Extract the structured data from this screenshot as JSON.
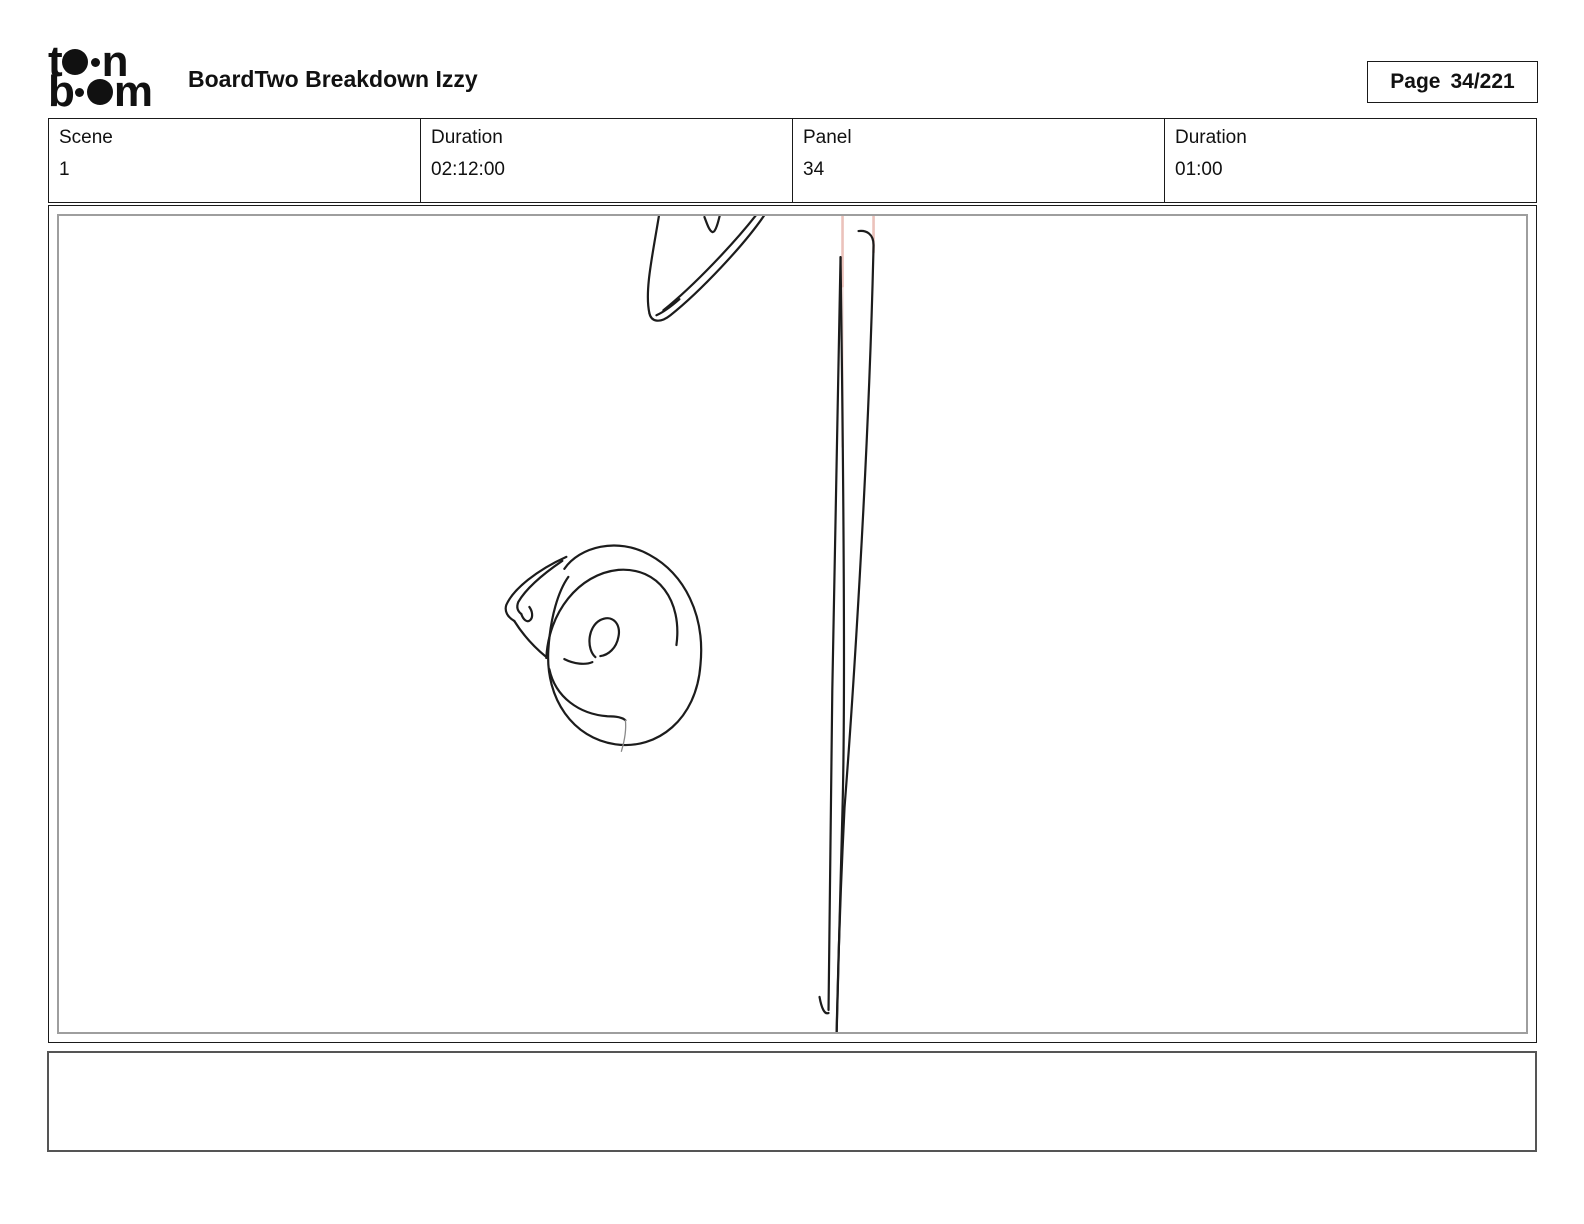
{
  "header": {
    "logo": {
      "name": "toonboom-logo",
      "row1": {
        "letter_left": "t",
        "letter_right": "n"
      },
      "row2": {
        "letter_left": "b",
        "letter_right": "m"
      }
    },
    "title": "BoardTwo Breakdown Izzy",
    "page_box": {
      "label": "Page",
      "value": "34/221"
    }
  },
  "info_table": {
    "cells": [
      {
        "label": "Scene",
        "value": "1"
      },
      {
        "label": "Duration",
        "value": "02:12:00"
      },
      {
        "label": "Panel",
        "value": "34"
      },
      {
        "label": "Duration",
        "value": "01:00"
      }
    ]
  },
  "panel": {
    "caption": "",
    "sketch_description": "rough pencil storyboard doodle: clipped cone/check shapes at top, long narrow vertical stroke ending in a down arrow with two faint pink guide lines, and a spiral snail-shell scribble with pointed flap at mid-left"
  },
  "colors": {
    "ink": "#1c1c1c",
    "border": "#1a1a1a",
    "panel_inner_border": "#9e9e9e",
    "caption_border": "#555555",
    "guide_pink": "#eabfb7"
  }
}
